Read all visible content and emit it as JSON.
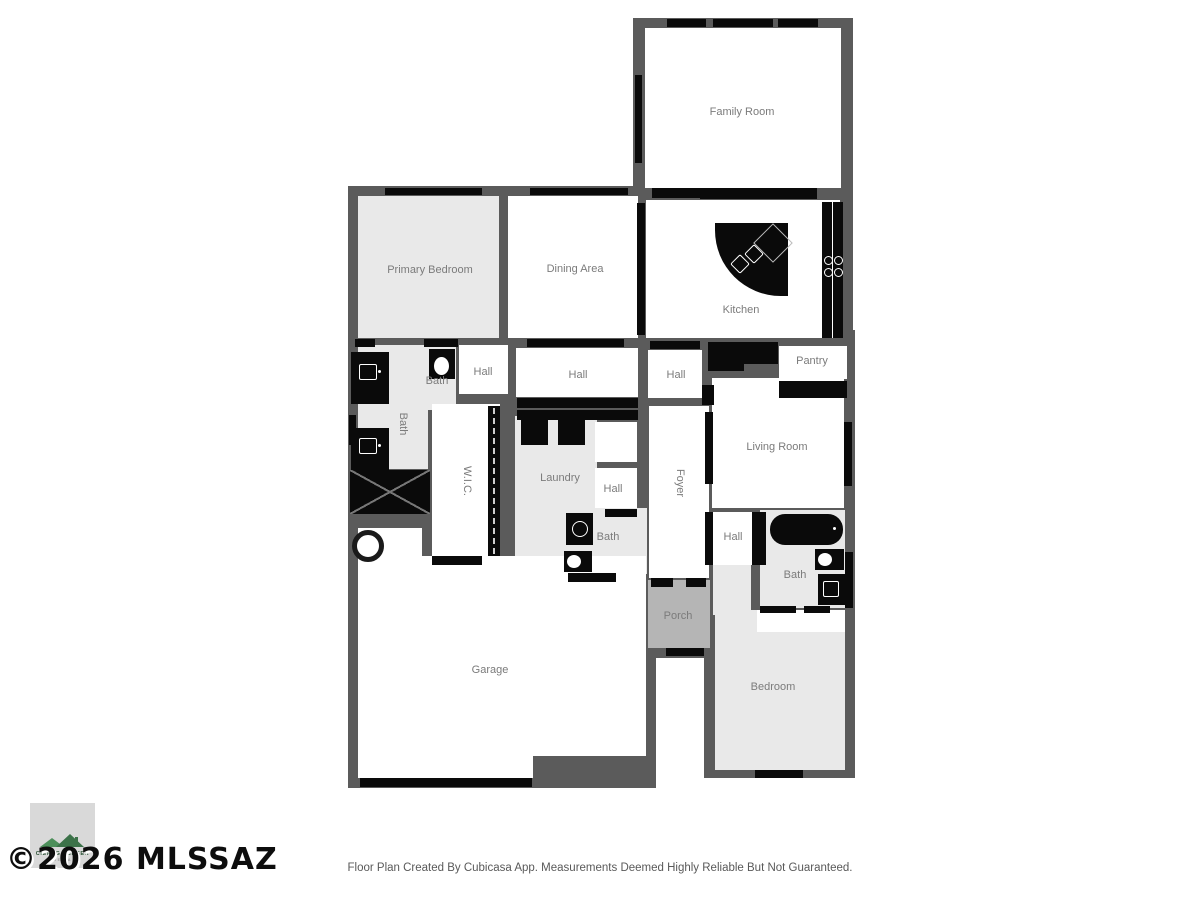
{
  "rooms": {
    "family_room": "Family Room",
    "primary_bedroom": "Primary Bedroom",
    "dining_area": "Dining Area",
    "kitchen": "Kitchen",
    "pantry": "Pantry",
    "living_room": "Living Room",
    "bath_primary": "Bath",
    "bath_small": "Bath",
    "bath_center": "Bath",
    "bath_guest": "Bath",
    "hall_upper_left": "Hall",
    "hall_center": "Hall",
    "hall_upper_right": "Hall",
    "hall_small": "Hall",
    "hall_lower_right": "Hall",
    "wic": "W.I.C.",
    "laundry": "Laundry",
    "foyer": "Foyer",
    "porch": "Porch",
    "garage": "Garage",
    "bedroom": "Bedroom"
  },
  "watermark": "©2026 MLSSAZ",
  "logo": {
    "name": "CIENEGA CREEK",
    "subtitle": "MEDIA"
  },
  "footer": {
    "disclaimer": "Floor Plan Created By Cubicasa App. Measurements Deemed Highly Reliable But Not Guaranteed."
  },
  "colors": {
    "wall": "#5b5b5b",
    "fixture": "#0a0a0a",
    "room_white": "#ffffff",
    "room_light": "#e9e9e9",
    "porch": "#b5b5b5",
    "label": "#7b7b7b",
    "logo_green": "#4c8f5a",
    "logo_green_dark": "#2c5236"
  }
}
